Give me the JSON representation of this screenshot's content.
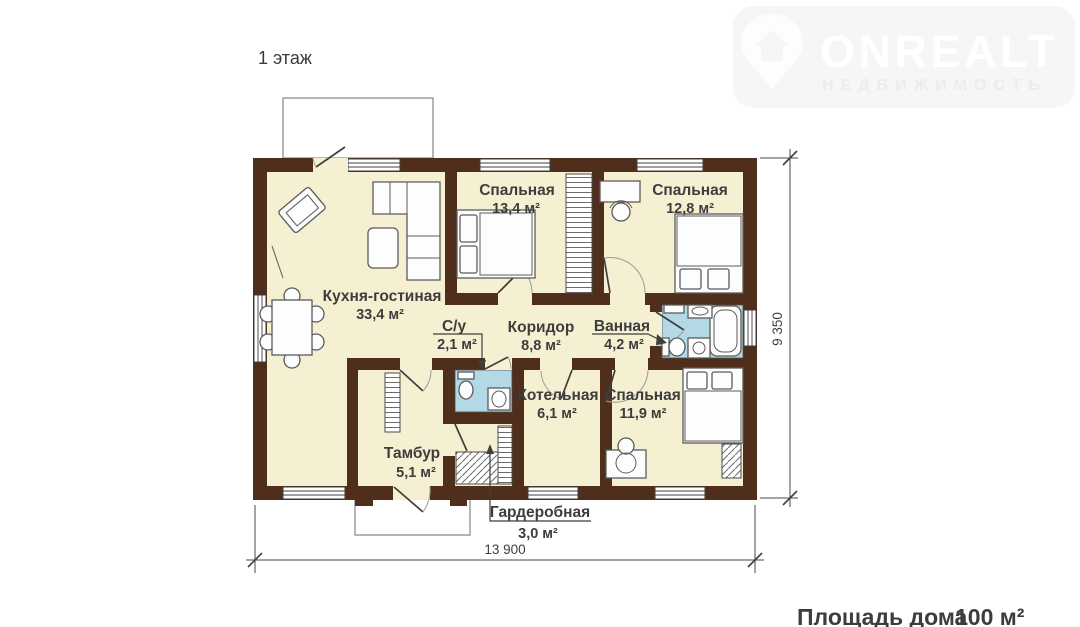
{
  "page": {
    "title": "1 этаж"
  },
  "watermark": {
    "brand": "ONREALT",
    "tagline": "НЕДВИЖИМОСТЬ",
    "icon": "house-pin-icon",
    "color": "#f6f6f6"
  },
  "plan": {
    "colors": {
      "wall": "#4f2e1c",
      "floor": "#f6f0d2",
      "tile": "#b3d9e6"
    },
    "rooms": [
      {
        "name": "Кухня-гостиная",
        "area": "33,4 м²"
      },
      {
        "name": "Спальная",
        "area": "13,4 м²"
      },
      {
        "name": "Спальная",
        "area": "12,8 м²"
      },
      {
        "name": "С/у",
        "area": "2,1 м²"
      },
      {
        "name": "Коридор",
        "area": "8,8 м²"
      },
      {
        "name": "Ванная",
        "area": "4,2 м²"
      },
      {
        "name": "Котельная",
        "area": "6,1 м²"
      },
      {
        "name": "Спальная",
        "area": "11,9 м²"
      },
      {
        "name": "Тамбур",
        "area": "5,1 м²"
      },
      {
        "name": "Гардеробная",
        "area": "3,0 м²"
      }
    ],
    "dimensions": {
      "width": "13 900",
      "height": "9 350"
    }
  },
  "footer": {
    "label": "Площадь дома",
    "value": "100 м²"
  }
}
